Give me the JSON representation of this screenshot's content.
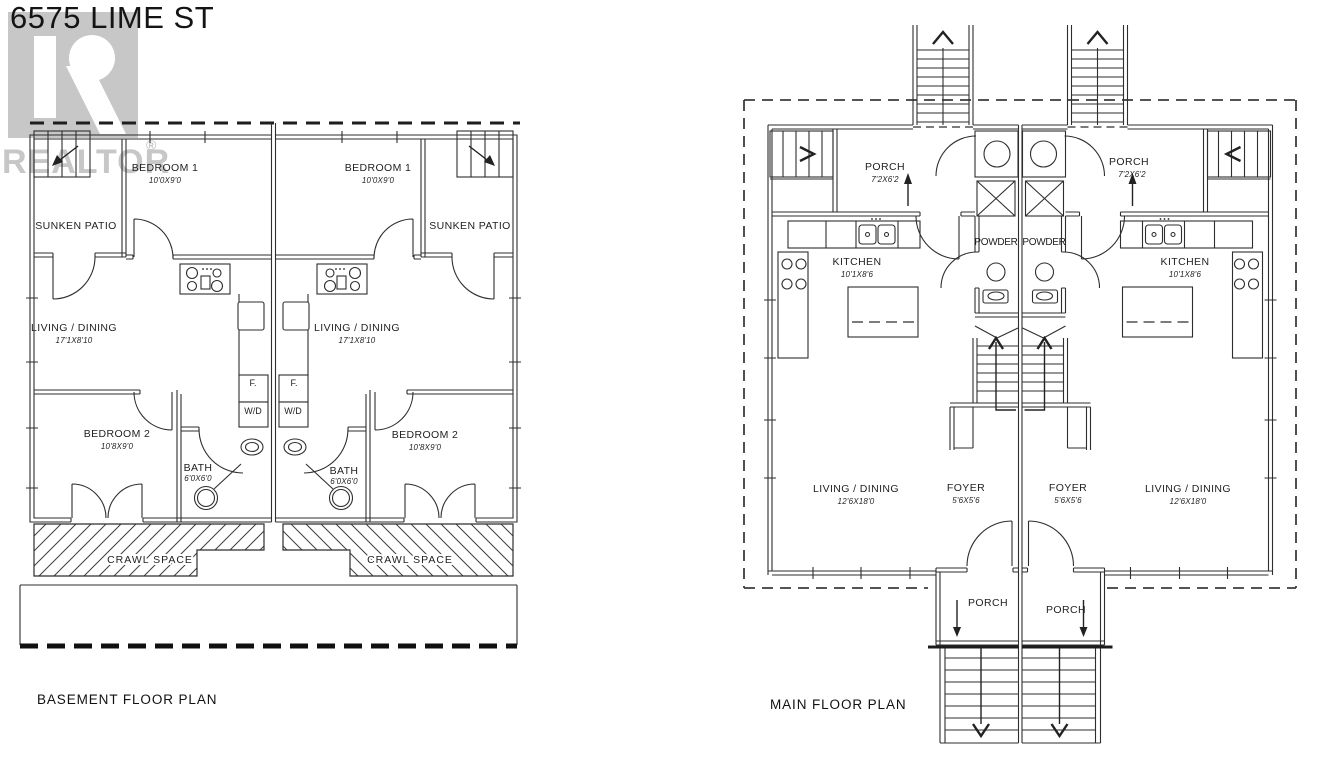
{
  "page": {
    "title": "6575 LIME ST",
    "background": "#ffffff",
    "line_color": "#2e2e2e",
    "watermark_color": "#c7c7c7"
  },
  "watermark": {
    "brand": "REALTOR",
    "registered_mark": "®"
  },
  "basement": {
    "caption": "BASEMENT FLOOR PLAN",
    "left_unit": {
      "bedroom1": {
        "label": "BEDROOM 1",
        "dim": "10'0X9'0"
      },
      "sunken_patio": {
        "label": "SUNKEN PATIO"
      },
      "living_dining": {
        "label": "LIVING / DINING",
        "dim": "17'1X8'10"
      },
      "bedroom2": {
        "label": "BEDROOM 2",
        "dim": "10'8X9'0"
      },
      "bath": {
        "label": "BATH",
        "dim": "6'0X6'0"
      },
      "furnace": {
        "label": "F."
      },
      "washer_dryer": {
        "label": "W/D"
      },
      "crawl_space": {
        "label": "CRAWL SPACE"
      }
    },
    "right_unit": {
      "bedroom1": {
        "label": "BEDROOM 1",
        "dim": "10'0X9'0"
      },
      "sunken_patio": {
        "label": "SUNKEN PATIO"
      },
      "living_dining": {
        "label": "LIVING / DINING",
        "dim": "17'1X8'10"
      },
      "bedroom2": {
        "label": "BEDROOM 2",
        "dim": "10'8X9'0"
      },
      "bath": {
        "label": "BATH",
        "dim": "6'0X6'0"
      },
      "furnace": {
        "label": "F."
      },
      "washer_dryer": {
        "label": "W/D"
      },
      "crawl_space": {
        "label": "CRAWL SPACE"
      }
    }
  },
  "main": {
    "caption": "MAIN FLOOR PLAN",
    "left_unit": {
      "porch_top": {
        "label": "PORCH",
        "dim": "7'2X6'2"
      },
      "kitchen": {
        "label": "KITCHEN",
        "dim": "10'1X8'6"
      },
      "powder": {
        "label": "POWDER"
      },
      "living_dining": {
        "label": "LIVING / DINING",
        "dim": "12'6X18'0"
      },
      "foyer": {
        "label": "FOYER",
        "dim": "5'6X5'6"
      },
      "porch_bottom": {
        "label": "PORCH"
      }
    },
    "right_unit": {
      "porch_top": {
        "label": "PORCH",
        "dim": "7'2X6'2"
      },
      "kitchen": {
        "label": "KITCHEN",
        "dim": "10'1X8'6"
      },
      "powder": {
        "label": "POWDER"
      },
      "living_dining": {
        "label": "LIVING / DINING",
        "dim": "12'6X18'0"
      },
      "foyer": {
        "label": "FOYER",
        "dim": "5'6X5'6"
      },
      "porch_bottom": {
        "label": "PORCH"
      }
    }
  }
}
